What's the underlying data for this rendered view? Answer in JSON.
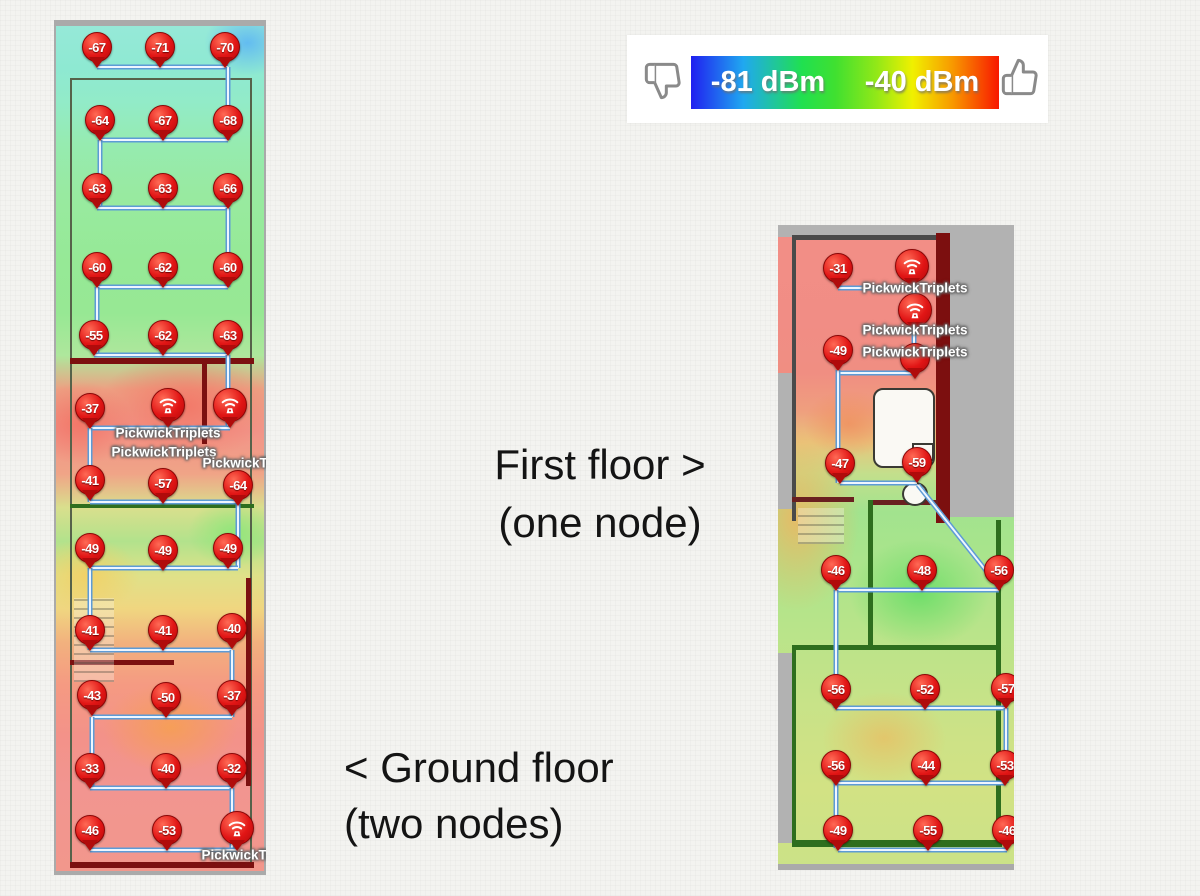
{
  "legend": {
    "low_label": "-81 dBm",
    "high_label": "-40 dBm",
    "gradient_colors": [
      "#2020f0",
      "#20a8f0",
      "#20e050",
      "#90e818",
      "#f0f000",
      "#f89800",
      "#f81800"
    ]
  },
  "captions": {
    "first_floor_line1": "First floor >",
    "first_floor_line2": "(one node)",
    "ground_floor_line1": "< Ground floor",
    "ground_floor_line2": "(two nodes)"
  },
  "node_name": "PickwickTriplets",
  "ground_floor": {
    "pins": [
      {
        "x": 43,
        "y": 27,
        "v": "-67"
      },
      {
        "x": 106,
        "y": 27,
        "v": "-71"
      },
      {
        "x": 171,
        "y": 27,
        "v": "-70"
      },
      {
        "x": 46,
        "y": 100,
        "v": "-64"
      },
      {
        "x": 109,
        "y": 100,
        "v": "-67"
      },
      {
        "x": 174,
        "y": 100,
        "v": "-68"
      },
      {
        "x": 43,
        "y": 168,
        "v": "-63"
      },
      {
        "x": 109,
        "y": 168,
        "v": "-63"
      },
      {
        "x": 174,
        "y": 168,
        "v": "-66"
      },
      {
        "x": 43,
        "y": 247,
        "v": "-60"
      },
      {
        "x": 109,
        "y": 247,
        "v": "-62"
      },
      {
        "x": 174,
        "y": 247,
        "v": "-60"
      },
      {
        "x": 40,
        "y": 315,
        "v": "-55"
      },
      {
        "x": 109,
        "y": 315,
        "v": "-62"
      },
      {
        "x": 174,
        "y": 315,
        "v": "-63"
      },
      {
        "x": 36,
        "y": 388,
        "v": "-37"
      },
      {
        "x": 36,
        "y": 460,
        "v": "-41"
      },
      {
        "x": 109,
        "y": 463,
        "v": "-57"
      },
      {
        "x": 184,
        "y": 465,
        "v": "-64"
      },
      {
        "x": 36,
        "y": 528,
        "v": "-49"
      },
      {
        "x": 109,
        "y": 530,
        "v": "-49"
      },
      {
        "x": 174,
        "y": 528,
        "v": "-49"
      },
      {
        "x": 36,
        "y": 610,
        "v": "-41"
      },
      {
        "x": 109,
        "y": 610,
        "v": "-41"
      },
      {
        "x": 178,
        "y": 608,
        "v": "-40"
      },
      {
        "x": 38,
        "y": 675,
        "v": "-43"
      },
      {
        "x": 112,
        "y": 677,
        "v": "-50"
      },
      {
        "x": 178,
        "y": 675,
        "v": "-37"
      },
      {
        "x": 36,
        "y": 748,
        "v": "-33"
      },
      {
        "x": 112,
        "y": 748,
        "v": "-40"
      },
      {
        "x": 178,
        "y": 748,
        "v": "-32"
      },
      {
        "x": 36,
        "y": 810,
        "v": "-46"
      },
      {
        "x": 113,
        "y": 810,
        "v": "-53"
      }
    ],
    "nodes": [
      {
        "x": 114,
        "y": 385
      },
      {
        "x": 176,
        "y": 385
      },
      {
        "x": 183,
        "y": 808
      }
    ],
    "labels": [
      {
        "x": 114,
        "y": 413,
        "text": "PickwickTriplets"
      },
      {
        "x": 110,
        "y": 432,
        "text": "PickwickTriplets"
      },
      {
        "x": 201,
        "y": 443,
        "text": "PickwickTriplets"
      },
      {
        "x": 200,
        "y": 835,
        "text": "PickwickTriplets"
      }
    ],
    "lines": [
      [
        43,
        47,
        174,
        47
      ],
      [
        174,
        47,
        174,
        120
      ],
      [
        46,
        120,
        174,
        120
      ],
      [
        46,
        120,
        46,
        188
      ],
      [
        43,
        188,
        174,
        188
      ],
      [
        174,
        188,
        174,
        267
      ],
      [
        43,
        267,
        174,
        267
      ],
      [
        43,
        267,
        43,
        335
      ],
      [
        40,
        335,
        174,
        335
      ],
      [
        174,
        335,
        174,
        408
      ],
      [
        36,
        408,
        176,
        408
      ],
      [
        36,
        408,
        36,
        482
      ],
      [
        36,
        482,
        184,
        482
      ],
      [
        184,
        482,
        184,
        548
      ],
      [
        36,
        548,
        184,
        548
      ],
      [
        36,
        548,
        36,
        630
      ],
      [
        36,
        630,
        178,
        630
      ],
      [
        178,
        630,
        178,
        697
      ],
      [
        38,
        697,
        178,
        697
      ],
      [
        38,
        697,
        38,
        768
      ],
      [
        36,
        768,
        178,
        768
      ],
      [
        178,
        768,
        178,
        828
      ],
      [
        36,
        830,
        183,
        830
      ]
    ]
  },
  "first_floor": {
    "pins": [
      {
        "x": 60,
        "y": 43,
        "v": "-31"
      },
      {
        "x": 60,
        "y": 125,
        "v": "-49"
      },
      {
        "x": 137,
        "y": 133,
        "v": ""
      },
      {
        "x": 62,
        "y": 238,
        "v": "-47"
      },
      {
        "x": 139,
        "y": 237,
        "v": "-59"
      },
      {
        "x": 58,
        "y": 345,
        "v": "-46"
      },
      {
        "x": 144,
        "y": 345,
        "v": "-48"
      },
      {
        "x": 221,
        "y": 345,
        "v": "-56"
      },
      {
        "x": 58,
        "y": 464,
        "v": "-56"
      },
      {
        "x": 147,
        "y": 464,
        "v": "-52"
      },
      {
        "x": 228,
        "y": 463,
        "v": "-57"
      },
      {
        "x": 58,
        "y": 540,
        "v": "-56"
      },
      {
        "x": 148,
        "y": 540,
        "v": "-44"
      },
      {
        "x": 227,
        "y": 540,
        "v": "-53"
      },
      {
        "x": 60,
        "y": 605,
        "v": "-49"
      },
      {
        "x": 150,
        "y": 605,
        "v": "-55"
      },
      {
        "x": 229,
        "y": 605,
        "v": "-46"
      }
    ],
    "nodes": [
      {
        "x": 134,
        "y": 41
      },
      {
        "x": 137,
        "y": 85
      }
    ],
    "labels": [
      {
        "x": 137,
        "y": 63,
        "text": "PickwickTriplets"
      },
      {
        "x": 137,
        "y": 105,
        "text": "PickwickTriplets"
      },
      {
        "x": 137,
        "y": 127,
        "text": "PickwickTriplets"
      }
    ],
    "lines": [
      [
        60,
        63,
        134,
        63
      ],
      [
        136,
        58,
        136,
        150
      ],
      [
        60,
        148,
        136,
        148
      ],
      [
        60,
        145,
        60,
        258
      ],
      [
        62,
        258,
        139,
        258
      ],
      [
        140,
        260,
        221,
        362
      ],
      [
        58,
        365,
        221,
        365
      ],
      [
        58,
        365,
        58,
        483
      ],
      [
        58,
        483,
        228,
        483
      ],
      [
        228,
        483,
        228,
        558
      ],
      [
        58,
        558,
        227,
        558
      ],
      [
        58,
        558,
        58,
        623
      ],
      [
        60,
        625,
        229,
        625
      ]
    ]
  },
  "chart_data": {
    "type": "heatmap",
    "title": "WiFi signal strength survey (dBm) over two floor plans",
    "legend": {
      "min": -81,
      "max": -40,
      "min_label": "-81 dBm",
      "max_label": "-40 dBm",
      "colormap": "blue-cyan-green-yellow-red"
    },
    "node_name": "PickwickTriplets",
    "series": [
      {
        "name": "Ground floor (two nodes)",
        "rows": [
          [
            -67,
            -71,
            -70
          ],
          [
            -64,
            -67,
            -68
          ],
          [
            -63,
            -63,
            -66
          ],
          [
            -60,
            -62,
            -60
          ],
          [
            -55,
            -62,
            -63
          ],
          [
            -37
          ],
          [
            -41,
            -57,
            -64
          ],
          [
            -49,
            -49,
            -49
          ],
          [
            -41,
            -41,
            -40
          ],
          [
            -43,
            -50,
            -37
          ],
          [
            -33,
            -40,
            -32
          ],
          [
            -46,
            -53
          ]
        ],
        "node_icons": 3
      },
      {
        "name": "First floor (one node)",
        "rows": [
          [
            -31
          ],
          [
            -49
          ],
          [
            -47,
            -59
          ],
          [
            -46,
            -48,
            -56
          ],
          [
            -56,
            -52,
            -57
          ],
          [
            -56,
            -44,
            -53
          ],
          [
            -49,
            -55,
            -46
          ]
        ],
        "node_icons": 2
      }
    ]
  }
}
